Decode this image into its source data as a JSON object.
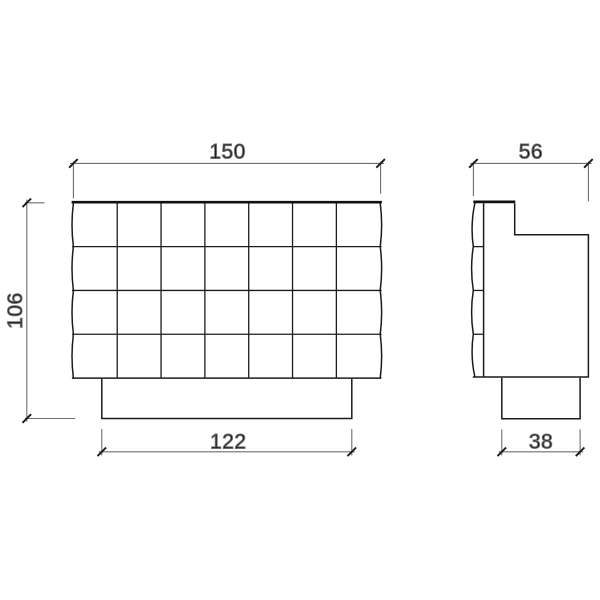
{
  "drawing": {
    "background_color": "#ffffff",
    "line_color": "#1c1c1c",
    "heavy_line_color": "#111111",
    "dimension_line_color": "#6e6e6e",
    "tick_color": "#1a1a1a",
    "text_color": "#111111",
    "views": {
      "front": {
        "grid_columns": 7,
        "grid_rows": 4
      },
      "side": {
        "cushion_rows": 4
      }
    },
    "dimensions": {
      "front_width": {
        "label": "150"
      },
      "side_depth": {
        "label": "56"
      },
      "front_height": {
        "label": "106"
      },
      "front_base_width": {
        "label": "122"
      },
      "side_base_depth": {
        "label": "38"
      }
    }
  }
}
